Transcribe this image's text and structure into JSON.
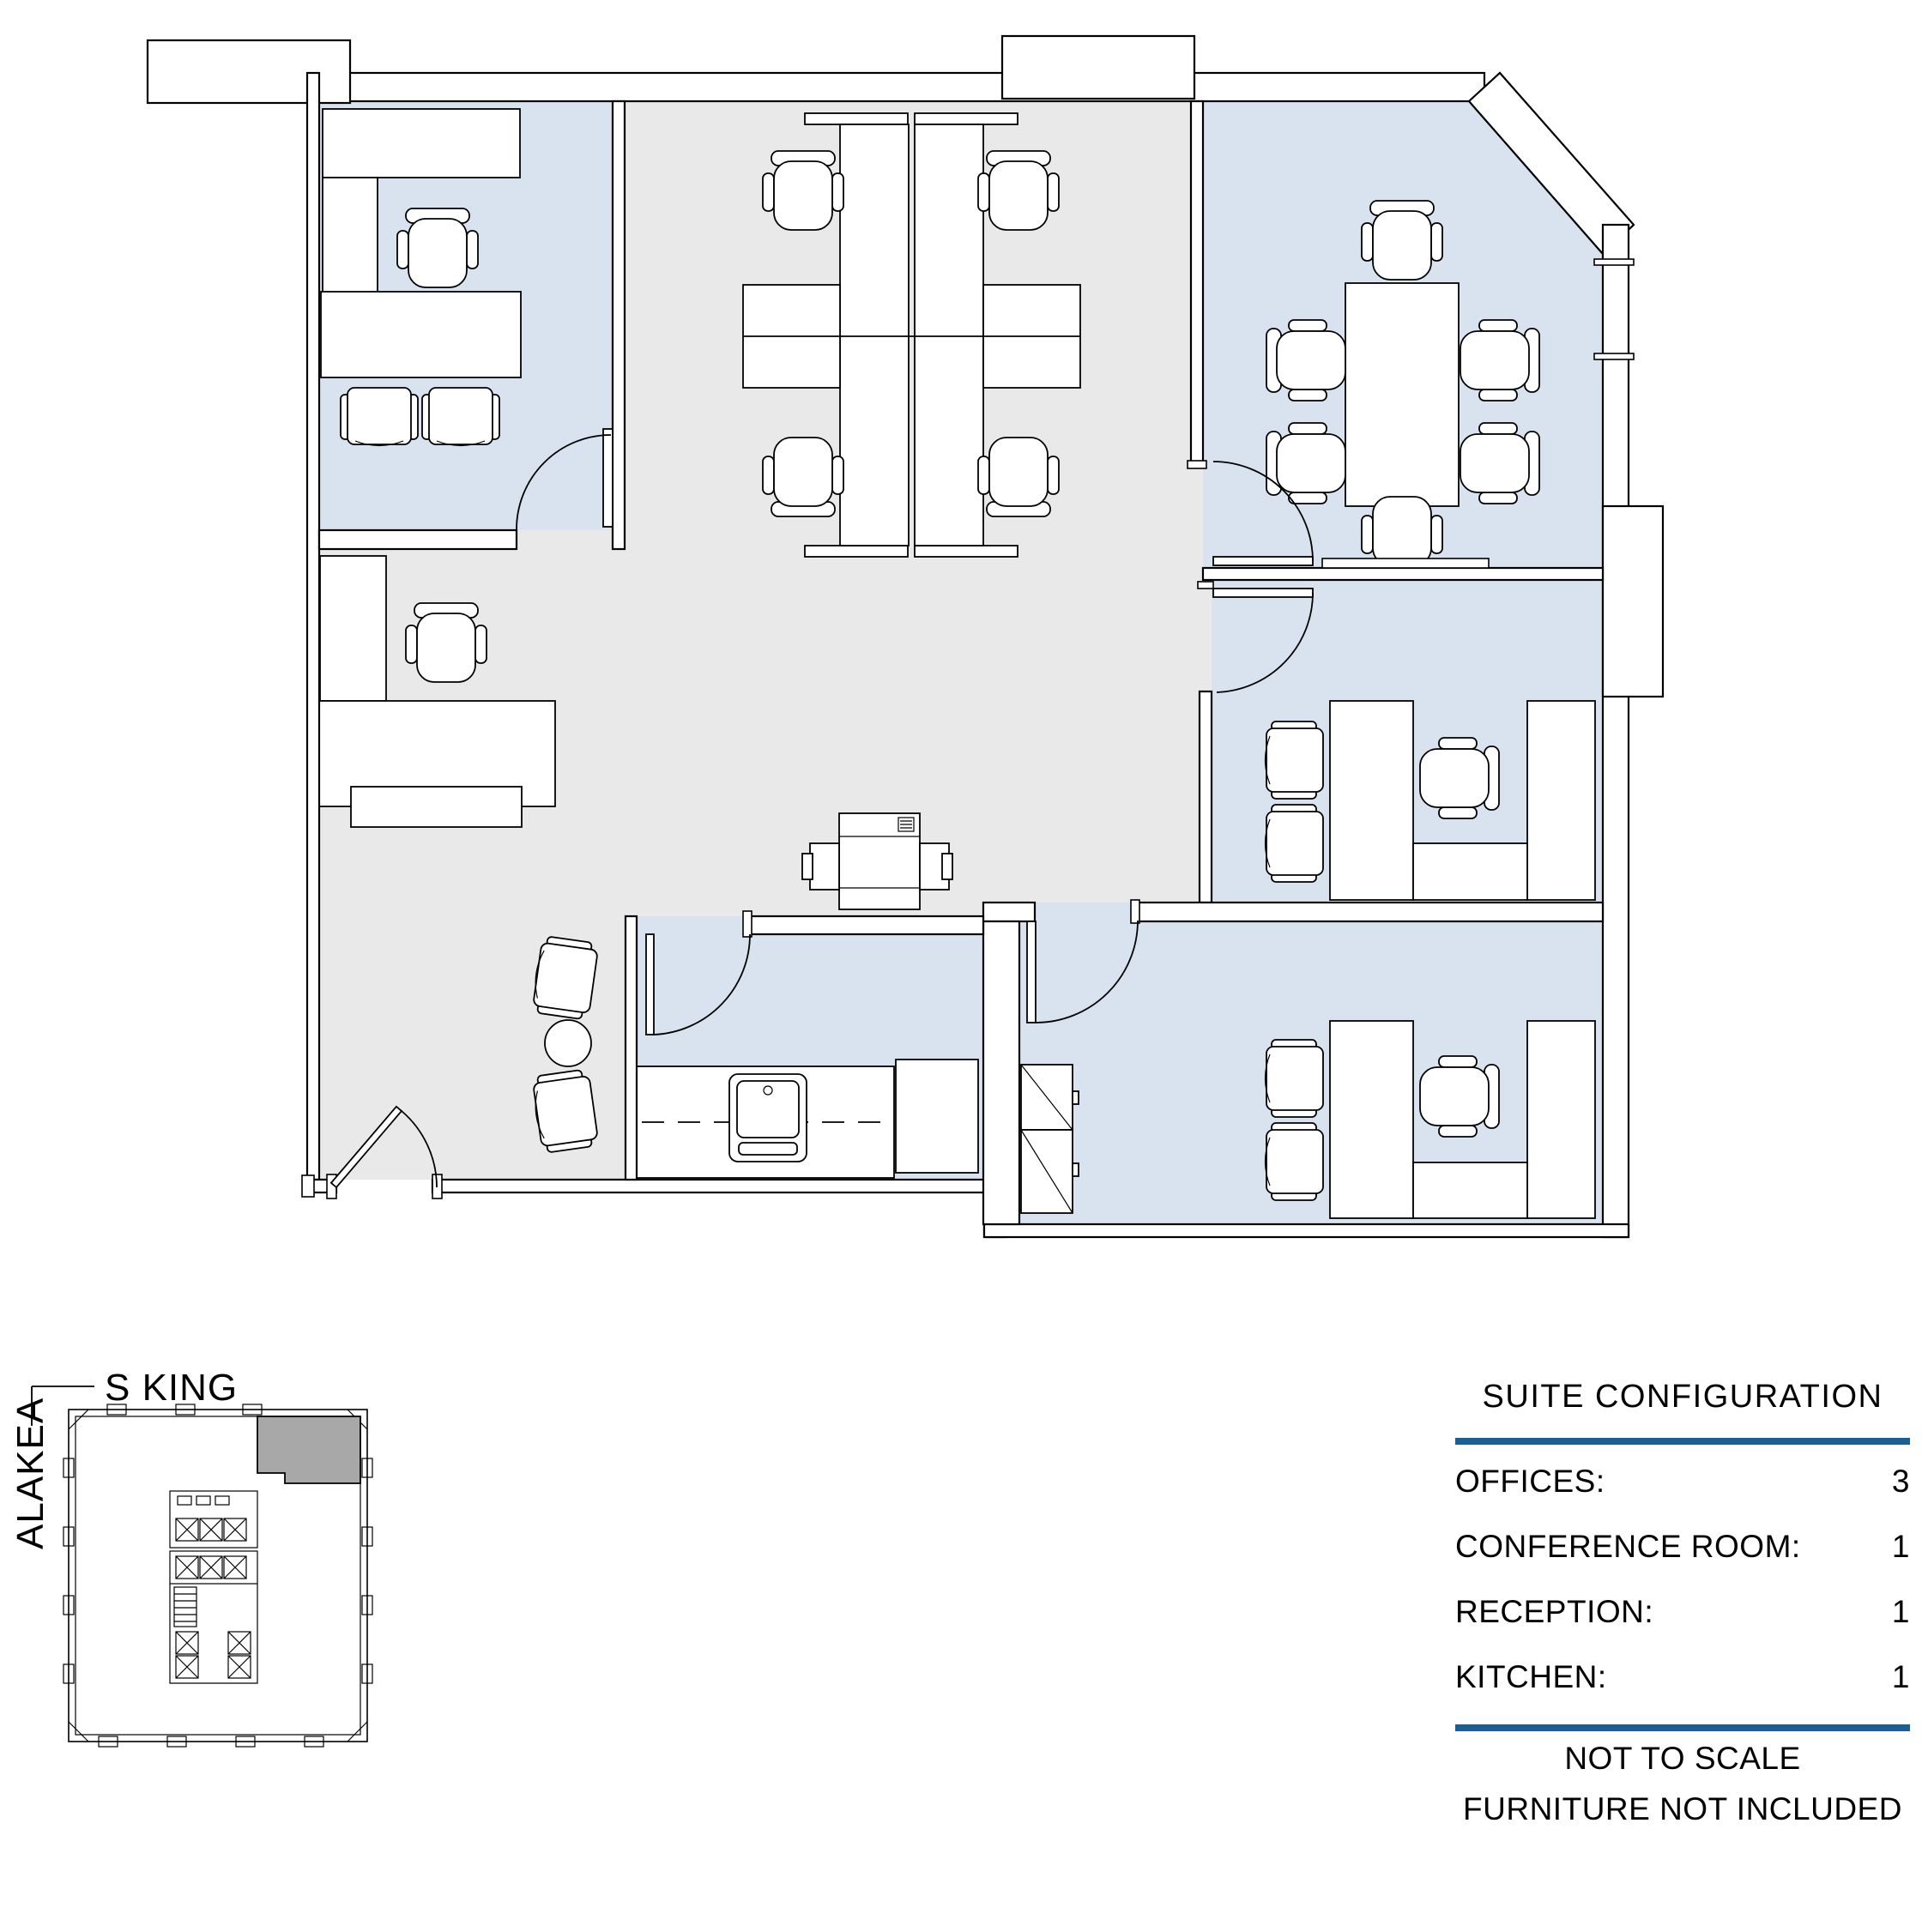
{
  "key_plan": {
    "street_top": "S KING",
    "street_left": "ALAKEA"
  },
  "panel": {
    "title": "SUITE CONFIGURATION",
    "rows": [
      {
        "label": "OFFICES:",
        "value": "3"
      },
      {
        "label": "CONFERENCE ROOM:",
        "value": "1"
      },
      {
        "label": "RECEPTION:",
        "value": "1"
      },
      {
        "label": "KITCHEN:",
        "value": "1"
      }
    ],
    "notes": [
      "NOT TO SCALE",
      "FURNITURE NOT INCLUDED"
    ]
  },
  "colors": {
    "room_fill": "#D9E3F0",
    "open_area_fill": "#E9E9E9",
    "keyplan_suite_fill": "#A8A8A8",
    "rule_blue": "#1D5F94",
    "line": "#000000"
  }
}
